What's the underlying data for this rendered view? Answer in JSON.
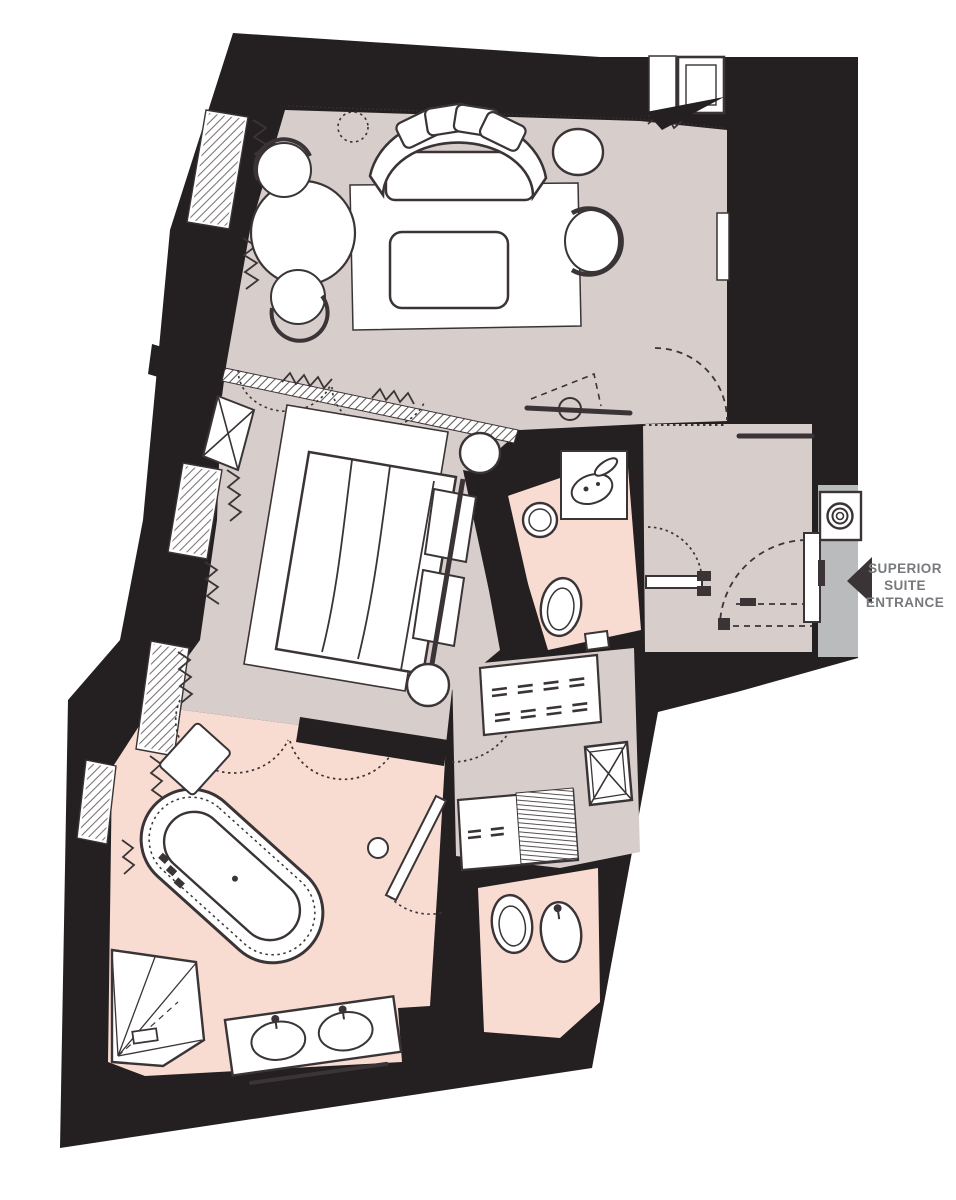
{
  "palette": {
    "wall": "#241f20",
    "floor": "#d7cdcb",
    "bath": "#f8dcd2",
    "corridor": "#b9bbbd",
    "line": "#3a3436",
    "white": "#ffffff",
    "label": "#77797c",
    "page_bg": "#ffffff"
  },
  "entrance": {
    "label_lines": [
      "SUPERIOR",
      "SUITE",
      "ENTRANCE"
    ],
    "arrow_direction": "left"
  }
}
